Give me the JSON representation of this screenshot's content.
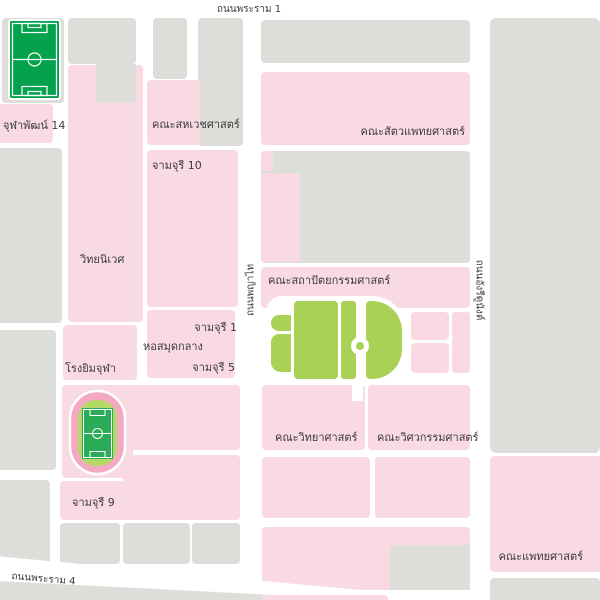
{
  "map": {
    "title": "Chulalongkorn University campus map",
    "roads": {
      "rama1": "ถนนพระราม 1",
      "rama4": "ถนนพระราม 4",
      "phayathai": "ถนนพญาไท",
      "henri_dunant": "ถนนอังรีดูนังต์"
    },
    "places": {
      "chulaphat14": "จุฬาพัฒน์ 14",
      "allied_health": "คณะสหเวชศาสตร์",
      "chamchuri10": "จามจุรี 10",
      "veterinary": "คณะสัตวแพทยศาสตร์",
      "withayaniwet": "วิทยนิเวศ",
      "architecture": "คณะสถาปัตยกรรมศาสตร์",
      "chamchuri1": "จามจุรี 1",
      "central_library": "หอสมุดกลาง",
      "chamchuri5": "จามจุรี 5",
      "chula_gym": "โรงยิมจุฬา",
      "chamchuri9": "จามจุรี 9",
      "science": "คณะวิทยาศาสตร์",
      "engineering": "คณะวิศวกรรมศาสตร์",
      "medicine": "คณะแพทยศาสตร์"
    },
    "icons": {
      "flag": "thai-flag-icon",
      "soccer_field": "soccer-field-icon",
      "stadium": "stadium-track-icon"
    },
    "colors": {
      "block_pink": "#F9DAE3",
      "block_gray": "#DDDDDA",
      "road_white": "#FFFFFF",
      "lawn_green": "#A9D155",
      "field_green": "#05A24E",
      "stadium_track_pink": "#F3A9C2",
      "stadium_infield_green": "#B4D967",
      "stadium_pitch_green": "#2BAC59",
      "label_text": "#3B3B3B",
      "flag_red": "#D7282F",
      "flag_blue": "#2D3089"
    }
  }
}
